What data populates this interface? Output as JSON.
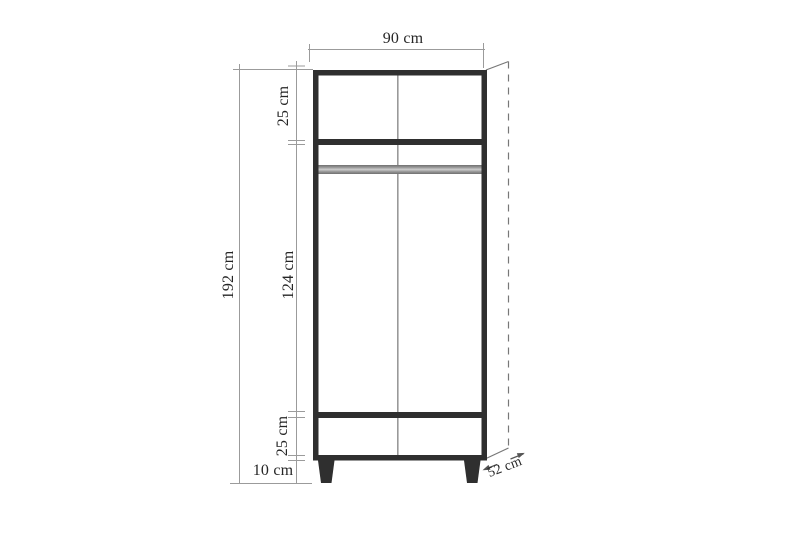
{
  "diagram": {
    "subject": "wardrobe dimension drawing",
    "labels": {
      "width_top": "90 cm",
      "section_top": "25 cm",
      "height_total": "192 cm",
      "section_middle": "124 cm",
      "section_bottom": "25 cm",
      "legs_height": "10 cm",
      "depth": "52 cm"
    },
    "colors": {
      "background": "#ffffff",
      "cabinet_outline": "#2f2f2f",
      "panel_divider": "#999999",
      "hanging_rod": "#8a8a8a",
      "dimension_line": "#9b9b9b",
      "depth_line": "#777777",
      "text": "#262626"
    }
  }
}
